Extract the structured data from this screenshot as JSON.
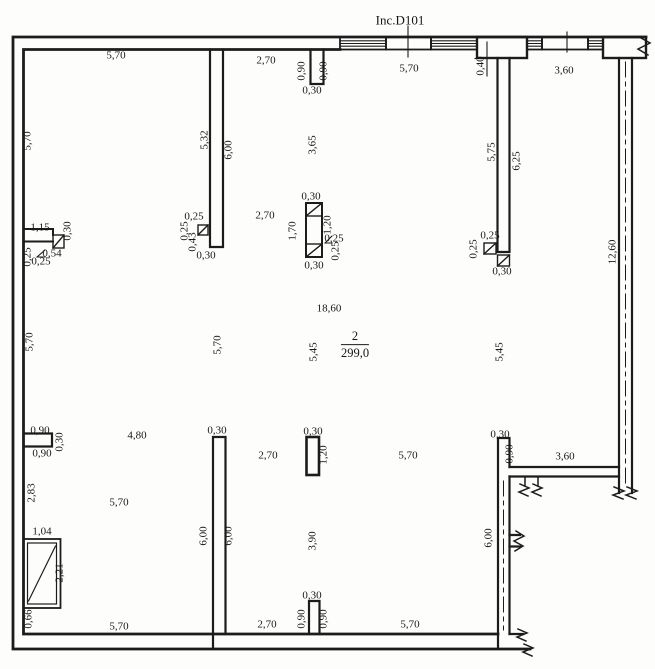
{
  "drawing": {
    "title": "Inc.D101",
    "room": {
      "number": "2",
      "area": "299,0"
    },
    "line_color": "#1c1c1c",
    "background": "#fdfdfc"
  },
  "dimension_labels": [
    {
      "text": "5,70",
      "x": 116,
      "y": 56,
      "rot": 0
    },
    {
      "text": "2,70",
      "x": 266,
      "y": 61,
      "rot": 0
    },
    {
      "text": "0,90",
      "x": 302,
      "y": 71,
      "rot": -90
    },
    {
      "text": "0,90",
      "x": 324,
      "y": 71,
      "rot": -90
    },
    {
      "text": "0,30",
      "x": 312,
      "y": 91,
      "rot": 0
    },
    {
      "text": "5,70",
      "x": 409,
      "y": 69,
      "rot": 0
    },
    {
      "text": "0,40",
      "x": 481,
      "y": 66,
      "rot": -90
    },
    {
      "text": "3,60",
      "x": 564,
      "y": 71,
      "rot": 0
    },
    {
      "text": "5,70",
      "x": 28,
      "y": 141,
      "rot": -90
    },
    {
      "text": "5,32",
      "x": 205,
      "y": 140,
      "rot": -90
    },
    {
      "text": "6,00",
      "x": 229,
      "y": 150,
      "rot": -90
    },
    {
      "text": "3,65",
      "x": 313,
      "y": 145,
      "rot": -90
    },
    {
      "text": "5,75",
      "x": 492,
      "y": 152,
      "rot": -90
    },
    {
      "text": "6,25",
      "x": 517,
      "y": 161,
      "rot": -90
    },
    {
      "text": "12,60",
      "x": 613,
      "y": 252,
      "rot": -90
    },
    {
      "text": "1,15",
      "x": 40,
      "y": 228,
      "rot": 0
    },
    {
      "text": "0,30",
      "x": 68,
      "y": 231,
      "rot": -90
    },
    {
      "text": "0,54",
      "x": 52,
      "y": 254,
      "rot": 0
    },
    {
      "text": "0,25",
      "x": 28,
      "y": 257,
      "rot": -90
    },
    {
      "text": "0,25",
      "x": 41,
      "y": 262,
      "rot": 0
    },
    {
      "text": "0,25",
      "x": 194,
      "y": 217,
      "rot": 0
    },
    {
      "text": "0,25",
      "x": 185,
      "y": 231,
      "rot": -90
    },
    {
      "text": "0,43",
      "x": 193,
      "y": 242,
      "rot": -90
    },
    {
      "text": "0,30",
      "x": 206,
      "y": 256,
      "rot": 0
    },
    {
      "text": "2,70",
      "x": 265,
      "y": 216,
      "rot": 0
    },
    {
      "text": "0,30",
      "x": 311,
      "y": 197,
      "rot": 0
    },
    {
      "text": "1,70",
      "x": 293,
      "y": 231,
      "rot": -90
    },
    {
      "text": "1,20",
      "x": 328,
      "y": 225,
      "rot": -90
    },
    {
      "text": "0,25",
      "x": 334,
      "y": 239,
      "rot": 0
    },
    {
      "text": "0,25",
      "x": 336,
      "y": 251,
      "rot": -90
    },
    {
      "text": "0,30",
      "x": 314,
      "y": 266,
      "rot": 0
    },
    {
      "text": "0,25",
      "x": 490,
      "y": 236,
      "rot": 0
    },
    {
      "text": "0,25",
      "x": 474,
      "y": 249,
      "rot": -90
    },
    {
      "text": "0,30",
      "x": 502,
      "y": 272,
      "rot": 0
    },
    {
      "text": "18,60",
      "x": 329,
      "y": 309,
      "rot": 0
    },
    {
      "text": "5,45",
      "x": 314,
      "y": 352,
      "rot": -90
    },
    {
      "text": "5,45",
      "x": 500,
      "y": 352,
      "rot": -90
    },
    {
      "text": "5,70",
      "x": 218,
      "y": 345,
      "rot": -90
    },
    {
      "text": "5,70",
      "x": 30,
      "y": 342,
      "rot": -90
    },
    {
      "text": "0,90",
      "x": 40,
      "y": 431,
      "rot": 0
    },
    {
      "text": "0,30",
      "x": 60,
      "y": 442,
      "rot": -90
    },
    {
      "text": "0,90",
      "x": 42,
      "y": 454,
      "rot": 0
    },
    {
      "text": "2,83",
      "x": 32,
      "y": 493,
      "rot": -90
    },
    {
      "text": "4,80",
      "x": 137,
      "y": 436,
      "rot": 0
    },
    {
      "text": "0,30",
      "x": 217,
      "y": 431,
      "rot": 0
    },
    {
      "text": "2,70",
      "x": 268,
      "y": 456,
      "rot": 0
    },
    {
      "text": "0,30",
      "x": 313,
      "y": 432,
      "rot": 0
    },
    {
      "text": "1,20",
      "x": 324,
      "y": 455,
      "rot": -90
    },
    {
      "text": "5,70",
      "x": 408,
      "y": 456,
      "rot": 0
    },
    {
      "text": "0,30",
      "x": 500,
      "y": 435,
      "rot": 0
    },
    {
      "text": "0,90",
      "x": 510,
      "y": 454,
      "rot": -90
    },
    {
      "text": "3,60",
      "x": 565,
      "y": 457,
      "rot": 0
    },
    {
      "text": "5,70",
      "x": 119,
      "y": 503,
      "rot": 0
    },
    {
      "text": "6,00",
      "x": 204,
      "y": 536,
      "rot": -90
    },
    {
      "text": "6,00",
      "x": 229,
      "y": 536,
      "rot": -90
    },
    {
      "text": "3,90",
      "x": 313,
      "y": 541,
      "rot": -90
    },
    {
      "text": "6,00",
      "x": 489,
      "y": 538,
      "rot": -90
    },
    {
      "text": "1,04",
      "x": 42,
      "y": 532,
      "rot": 0
    },
    {
      "text": "2,21",
      "x": 60,
      "y": 573,
      "rot": -90
    },
    {
      "text": "0,66",
      "x": 29,
      "y": 619,
      "rot": -90
    },
    {
      "text": "0,30",
      "x": 312,
      "y": 596,
      "rot": 0
    },
    {
      "text": "0,90",
      "x": 302,
      "y": 619,
      "rot": -90
    },
    {
      "text": "0,90",
      "x": 324,
      "y": 619,
      "rot": -90
    },
    {
      "text": "2,70",
      "x": 267,
      "y": 625,
      "rot": 0
    },
    {
      "text": "5,70",
      "x": 410,
      "y": 625,
      "rot": 0
    },
    {
      "text": "5,70",
      "x": 119,
      "y": 627,
      "rot": 0
    }
  ]
}
